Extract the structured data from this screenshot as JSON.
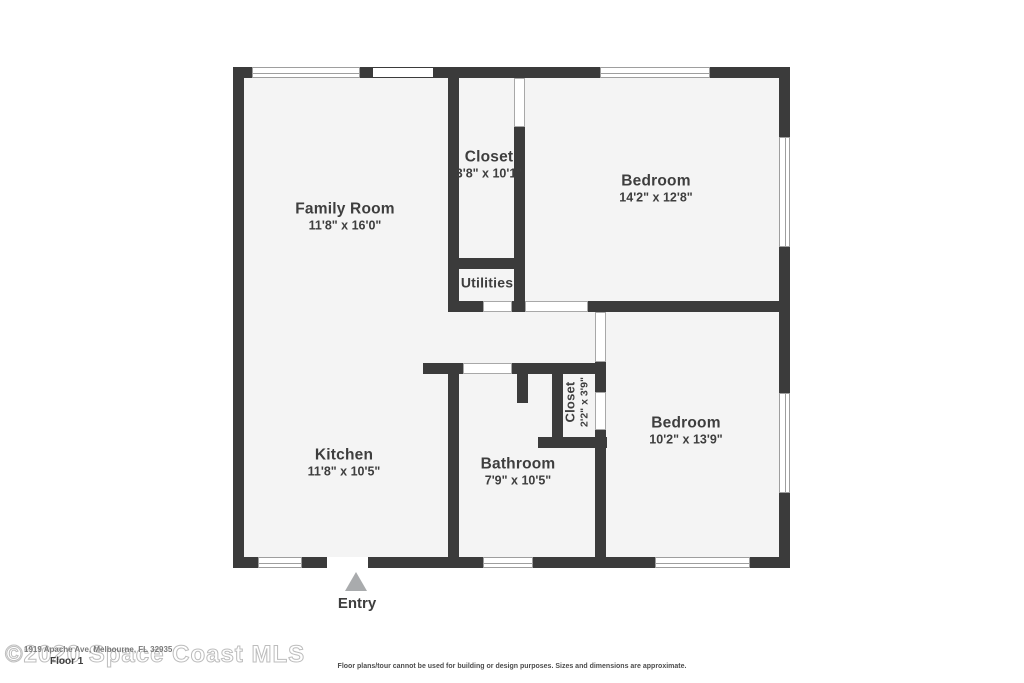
{
  "plan": {
    "rooms": [
      {
        "name": "Family Room",
        "dims": "11'8\" x 16'0\""
      },
      {
        "name": "Closet",
        "dims": "3'8\" x 10'1\""
      },
      {
        "name": "Bedroom",
        "dims": "14'2\" x 12'8\""
      },
      {
        "name": "Utilities",
        "dims": ""
      },
      {
        "name": "Kitchen",
        "dims": "11'8\" x 10'5\""
      },
      {
        "name": "Bathroom",
        "dims": "7'9\" x 10'5\""
      },
      {
        "name": "Closet",
        "dims": "2'2\" x 3'9\""
      },
      {
        "name": "Bedroom",
        "dims": "10'2\" x 13'9\""
      }
    ],
    "entry_label": "Entry"
  },
  "footer": {
    "watermark": "©2020 Space Coast MLS",
    "address": "1919 Apache Ave, Melbourne, FL 32935",
    "floor_label": "Floor 1",
    "disclaimer": "Floor plans/tour cannot be used for building or design purposes. Sizes and dimensions are approximate."
  },
  "colors": {
    "wall": "#3b3b3b",
    "floor": "#f4f4f4",
    "label_text": "#3e3e3e",
    "entry_arrow": "#a9abad",
    "watermark_outline": "#bdbdbd"
  }
}
